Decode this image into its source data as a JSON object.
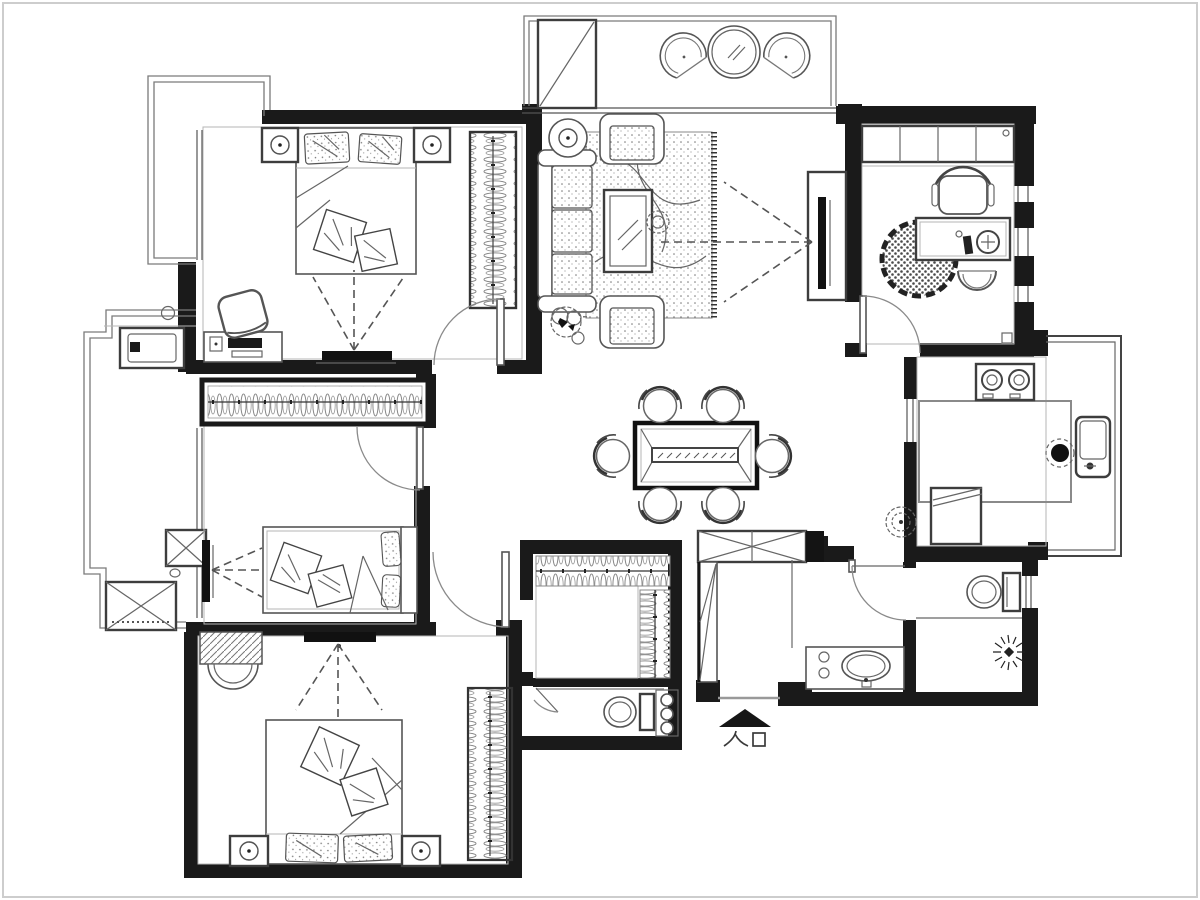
{
  "meta": {
    "kind": "apartment-floor-plan"
  },
  "entry": {
    "label": "入口"
  },
  "colors": {
    "walls": "#1a1a1a",
    "furniture": "#555555",
    "light_lines": "#b5b5b5",
    "dashed_sightlines": "#555555",
    "background": "#ffffff",
    "frame": "#cdcdcd"
  },
  "icons": {
    "entry_marker": "entry-arrow-icon",
    "bed": "bed-icon",
    "wardrobe": "wardrobe-icon",
    "sofa": "sofa-icon",
    "armchair": "armchair-icon",
    "coffee_table": "coffee-table-icon",
    "rug": "rug-icon",
    "tv": "tv-icon",
    "dining_table": "dining-table-icon",
    "dining_chair": "chair-icon",
    "desk": "desk-icon",
    "office_chair": "office-chair-icon",
    "bookshelf": "bookshelf-icon",
    "stove": "stove-icon",
    "kitchen_sink": "sink-icon",
    "basin": "basin-icon",
    "toilet": "toilet-icon",
    "shower": "shower-icon",
    "washing_machine": "washing-machine-icon",
    "plant": "plant-icon",
    "ceiling_fan": "fan-icon",
    "door": "door-icon",
    "window": "window-icon"
  }
}
